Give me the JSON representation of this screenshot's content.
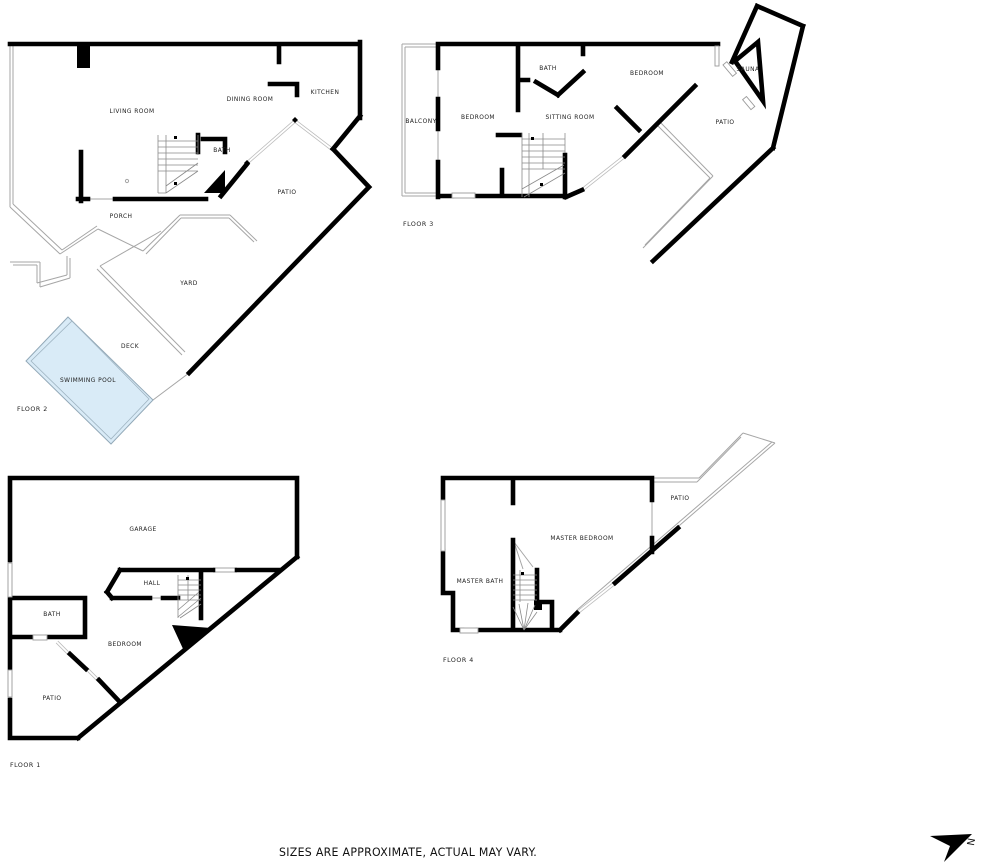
{
  "disclaimer": "SIZES ARE APPROXIMATE, ACTUAL MAY VARY.",
  "compass": {
    "letter": "N"
  },
  "colors": {
    "wall": "#000000",
    "thin_line": "#a6a6a6",
    "pool_fill": "#d9ebf7",
    "text": "#222222",
    "background": "#ffffff"
  },
  "floors": [
    {
      "label": "FLOOR 2",
      "rooms": [
        {
          "label": "LIVING ROOM"
        },
        {
          "label": "DINING ROOM"
        },
        {
          "label": "KITCHEN"
        },
        {
          "label": "BATH"
        },
        {
          "label": "PATIO"
        },
        {
          "label": "PORCH"
        },
        {
          "label": "YARD"
        },
        {
          "label": "DECK"
        },
        {
          "label": "SWIMMING POOL"
        }
      ]
    },
    {
      "label": "FLOOR 3",
      "rooms": [
        {
          "label": "BALCONY"
        },
        {
          "label": "BEDROOM"
        },
        {
          "label": "BATH"
        },
        {
          "label": "SITTING ROOM"
        },
        {
          "label": "BEDROOM"
        },
        {
          "label": "SAUNA"
        },
        {
          "label": "PATIO"
        }
      ]
    },
    {
      "label": "FLOOR 1",
      "rooms": [
        {
          "label": "GARAGE"
        },
        {
          "label": "HALL"
        },
        {
          "label": "BATH"
        },
        {
          "label": "BEDROOM"
        },
        {
          "label": "PATIO"
        }
      ]
    },
    {
      "label": "FLOOR 4",
      "rooms": [
        {
          "label": "MASTER BATH"
        },
        {
          "label": "MASTER BEDROOM"
        },
        {
          "label": "PATIO"
        }
      ]
    }
  ]
}
